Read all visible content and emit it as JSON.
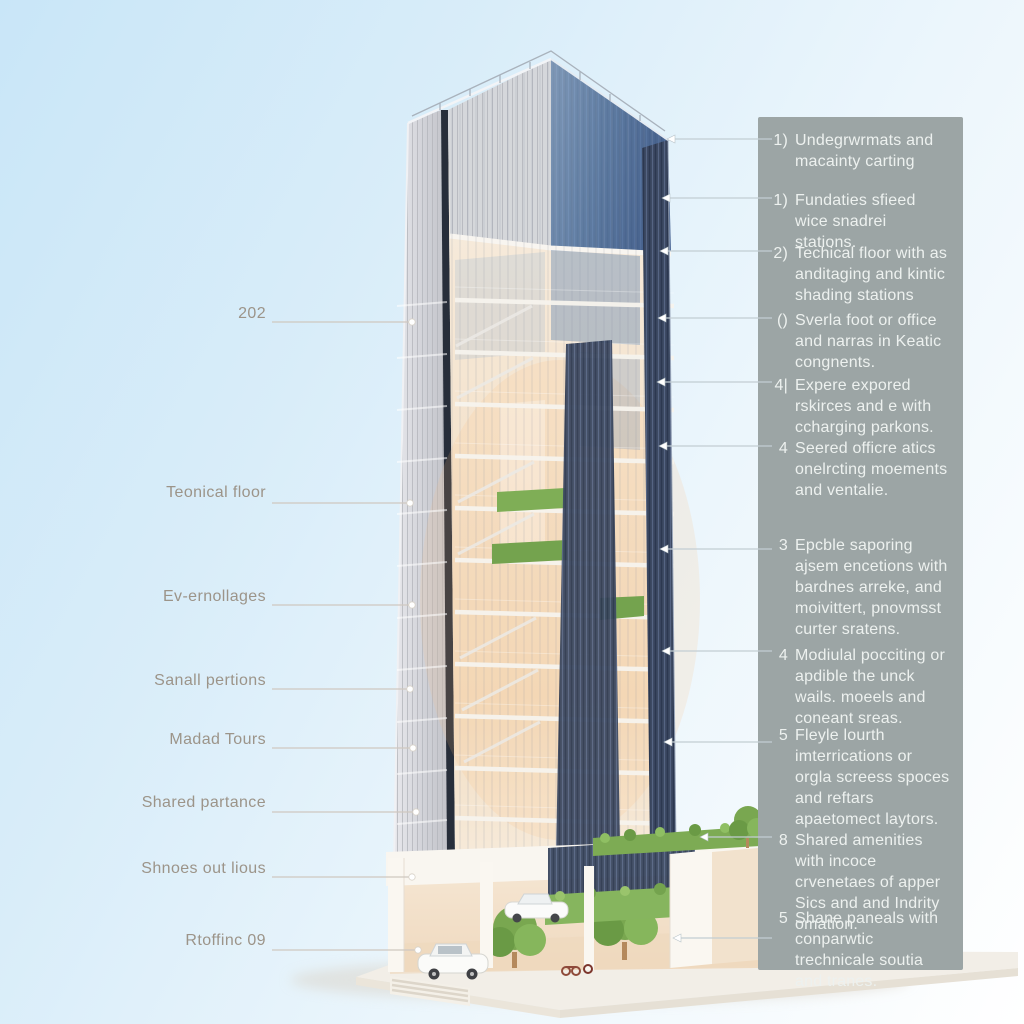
{
  "colors": {
    "sky_top": "#c9e6f8",
    "sky_bottom": "#ffffff",
    "panel_bg": "#9ca5a5",
    "panel_text": "#edf1ef",
    "label_text": "#9c9489",
    "leader_left": "#cfc8c0",
    "leader_right": "#c2cdd3",
    "facade_navy": "#3d4a63",
    "facade_glass_warm": "#f3ddc2",
    "facade_glass_blue": "#6e92bd",
    "greenery": "#7caf55",
    "podium_white": "#f9f6f0"
  },
  "left_labels": [
    {
      "text": "202",
      "y": 314,
      "line_y": 322,
      "end_x": 412
    },
    {
      "text": "Teonical floor",
      "y": 493,
      "line_y": 503,
      "end_x": 410
    },
    {
      "text": "Ev-ernollages",
      "y": 597,
      "line_y": 605,
      "end_x": 412
    },
    {
      "text": "Sanall pertions",
      "y": 681,
      "line_y": 689,
      "end_x": 410
    },
    {
      "text": "Madad Tours",
      "y": 740,
      "line_y": 748,
      "end_x": 413
    },
    {
      "text": "Shared partance",
      "y": 803,
      "line_y": 812,
      "end_x": 416
    },
    {
      "text": "Shnoes out lious",
      "y": 869,
      "line_y": 877,
      "end_x": 412
    },
    {
      "text": "Rtoffinc 09",
      "y": 941,
      "line_y": 950,
      "end_x": 418
    }
  ],
  "annotations": [
    {
      "num": "1)",
      "text": "Undegrwrmats and macainty carting",
      "top": 130,
      "line_y": 139,
      "end_x": 667
    },
    {
      "num": "1)",
      "text": "Fundaties sfieed wice snadrei stations.",
      "top": 190,
      "line_y": 198,
      "end_x": 662
    },
    {
      "num": "2)",
      "text": "Techical floor with as anditaging and kintic shading stations",
      "top": 243,
      "line_y": 251,
      "end_x": 660
    },
    {
      "num": "()",
      "text": "Sverla foot or office and narras in Keatic congnents.",
      "top": 310,
      "line_y": 318,
      "end_x": 658
    },
    {
      "num": "4|",
      "text": "Expere expored rskirces and e with ccharging parkons.",
      "top": 375,
      "line_y": 382,
      "end_x": 657
    },
    {
      "num": "4",
      "text": "Seered officre atics onelrcting moements and ventalie.",
      "top": 438,
      "line_y": 446,
      "end_x": 659
    },
    {
      "num": "3",
      "text": "Epcble saporing ajsem encetions with bardnes arreke, and moivittert, pnovmsst curter sratens.",
      "top": 535,
      "line_y": 549,
      "end_x": 660
    },
    {
      "num": "4",
      "text": "Modiulal pocciting or apdible the unck wails. moeels and coneant sreas.",
      "top": 645,
      "line_y": 651,
      "end_x": 662
    },
    {
      "num": "5",
      "text": "Fleyle lourth imterrications or orgla screess spoces and reftars apaetomect laytors.",
      "top": 725,
      "line_y": 742,
      "end_x": 664
    },
    {
      "num": "8",
      "text": "Shared amenities with incoce crvenetaes of apper Sics and and Indrity omation.",
      "top": 830,
      "line_y": 837,
      "end_x": 700
    },
    {
      "num": "5",
      "text": "Shane paneals with conparwtic trechnicale soutia and tranes.",
      "top": 908,
      "line_y": 938,
      "end_x": 673
    }
  ]
}
